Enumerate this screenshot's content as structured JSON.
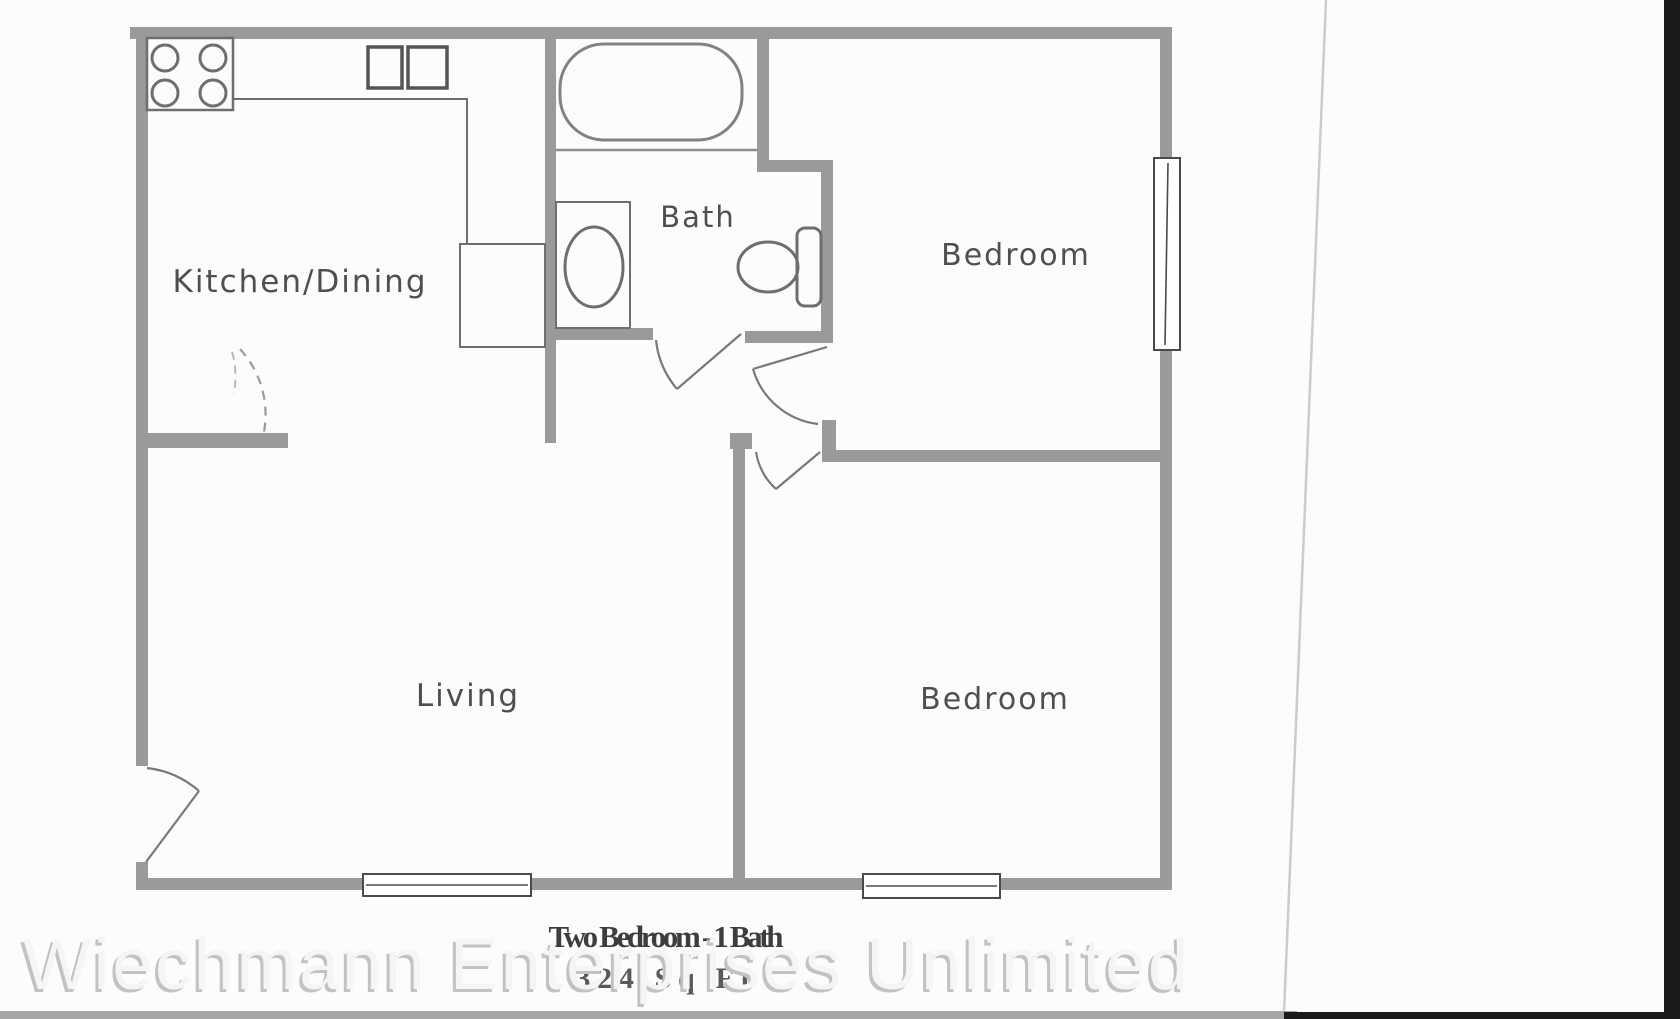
{
  "document": {
    "kind": "scanned floor plan",
    "title": "Two Bedroom - 1 Bath",
    "area": "324 Sq Ft",
    "watermark": "Wiechmann Enterprises Unlimited"
  },
  "rooms": {
    "kitchen_dining": "Kitchen/Dining",
    "bath": "Bath",
    "bedroom_top": "Bedroom",
    "bedroom_bottom": "Bedroom",
    "living": "Living"
  },
  "fixtures": {
    "stove": "stove-burners-icon",
    "kitchen_sink": "double-sink-icon",
    "refrigerator": "refrigerator-icon",
    "counter": "counter-line",
    "bathtub": "bathtub-icon",
    "bath_sink": "bath-sink-icon",
    "toilet": "toilet-icon",
    "windows": "window-symbol",
    "doors": "door-swing-symbol"
  },
  "colors": {
    "wall": "#9a9a9a",
    "fixture_line": "#6e6e6e",
    "label_text": "#4f4f4f",
    "title_text": "#3d3d3d",
    "watermark_fill": "#f5f5f4",
    "watermark_shadow": "#c2c2c2",
    "paper": "#fcfcfb",
    "scan_bottom_bar": "#a6a6a6",
    "scan_edge_black": "#1b1b1b",
    "paper_edge_line": "#cccccc"
  }
}
